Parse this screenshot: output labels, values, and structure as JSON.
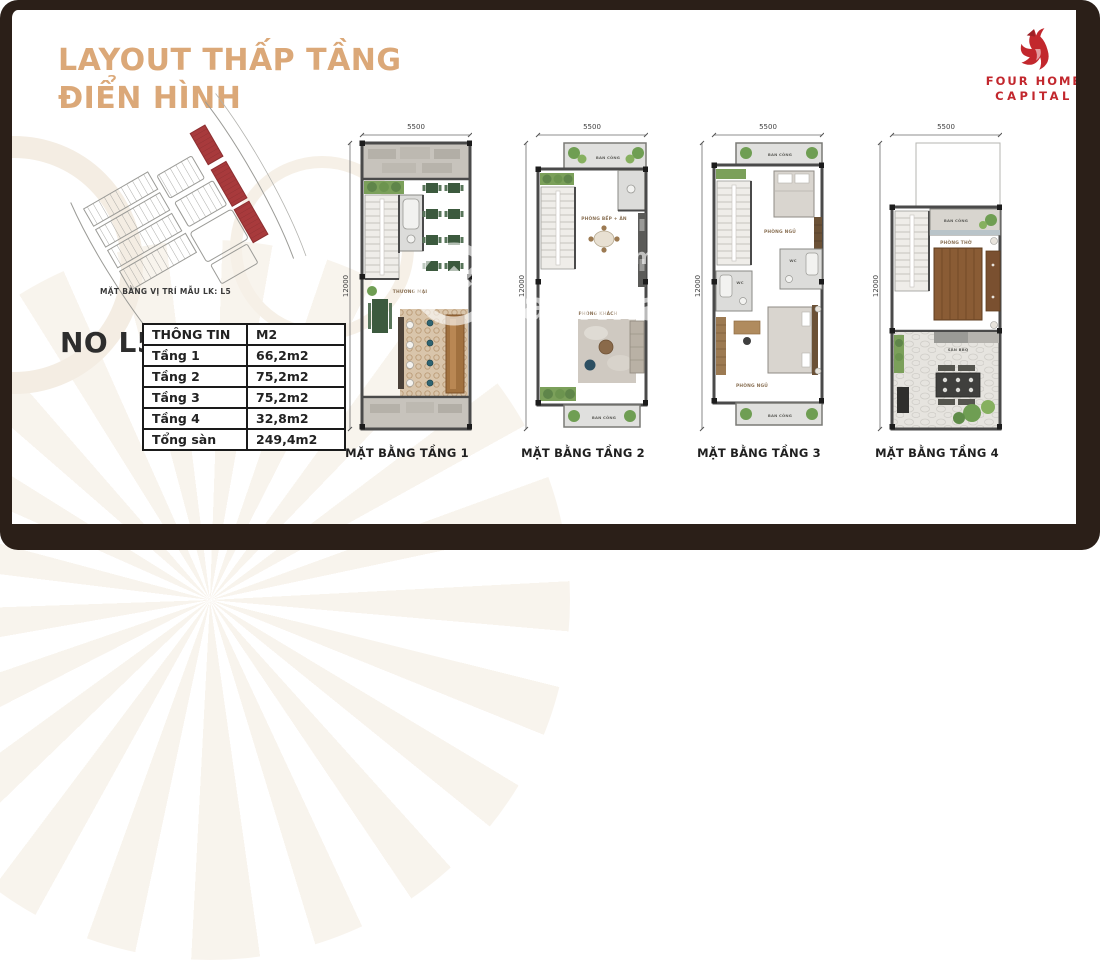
{
  "header": {
    "title_line1": "LAYOUT THẤP TẦNG",
    "title_line2": "ĐIỂN HÌNH",
    "title_color": "#DBA878"
  },
  "logo": {
    "line1": "FOUR HOME",
    "line2": "CAPITAL",
    "color": "#C2272D",
    "icon": "phoenix-flame-icon"
  },
  "site_map": {
    "caption": "MẶT BẰNG VỊ TRÍ MẪU LK: L5",
    "highlight_color": "#A83A3C",
    "outline_color": "#9B9B97"
  },
  "unit": {
    "code": "NO L5",
    "table": {
      "header": {
        "col1": "THÔNG TIN",
        "col2": "M2"
      },
      "rows": [
        {
          "label": "Tầng 1",
          "value": "66,2m2"
        },
        {
          "label": "Tầng 2",
          "value": "75,2m2"
        },
        {
          "label": "Tầng 3",
          "value": "75,2m2"
        },
        {
          "label": "Tầng 4",
          "value": "32,8m2"
        },
        {
          "label": "Tổng sàn",
          "value": "249,4m2"
        }
      ]
    }
  },
  "plans": [
    {
      "caption": "MẶT BẰNG TẦNG 1",
      "width_dim": "5500",
      "height_dim": "12000",
      "rooms": {
        "commercial": "THƯƠNG MẠI"
      }
    },
    {
      "caption": "MẶT BẰNG TẦNG 2",
      "width_dim": "5500",
      "height_dim": "12000",
      "rooms": {
        "balcony_top": "BAN CÔNG",
        "kitchen_dining": "PHÒNG BẾP + ĂN",
        "living": "PHÒNG KHÁCH",
        "balcony_bottom": "BAN CÔNG"
      }
    },
    {
      "caption": "MẶT BẰNG TẦNG 3",
      "width_dim": "5500",
      "height_dim": "12000",
      "rooms": {
        "balcony_top": "BAN CÔNG",
        "bedroom_top": "PHÒNG NGỦ",
        "wc_left": "WC",
        "wc_right": "WC",
        "bedroom_bottom": "PHÒNG NGỦ",
        "balcony_bottom": "BAN CÔNG"
      }
    },
    {
      "caption": "MẶT BẰNG TẦNG 4",
      "width_dim": "5500",
      "height_dim": "12000",
      "rooms": {
        "balcony": "BAN CÔNG",
        "worship": "PHÒNG THỜ",
        "bbq_terrace": "SÂN BBQ"
      }
    }
  ],
  "watermark": {
    "site_text": "gcaoNhaDa",
    "domain_text": ".com.v"
  },
  "palette": {
    "frame_border": "#2B1F18",
    "floor_tan": "#C9A57F",
    "tile_beige": "#E7DCC8",
    "wall_gray": "#4A4A4A",
    "stone_gray": "#C7C3BC",
    "plant_green": "#6F9E53",
    "table_green": "#3C5A3E",
    "bar_brown": "#A1713F"
  }
}
